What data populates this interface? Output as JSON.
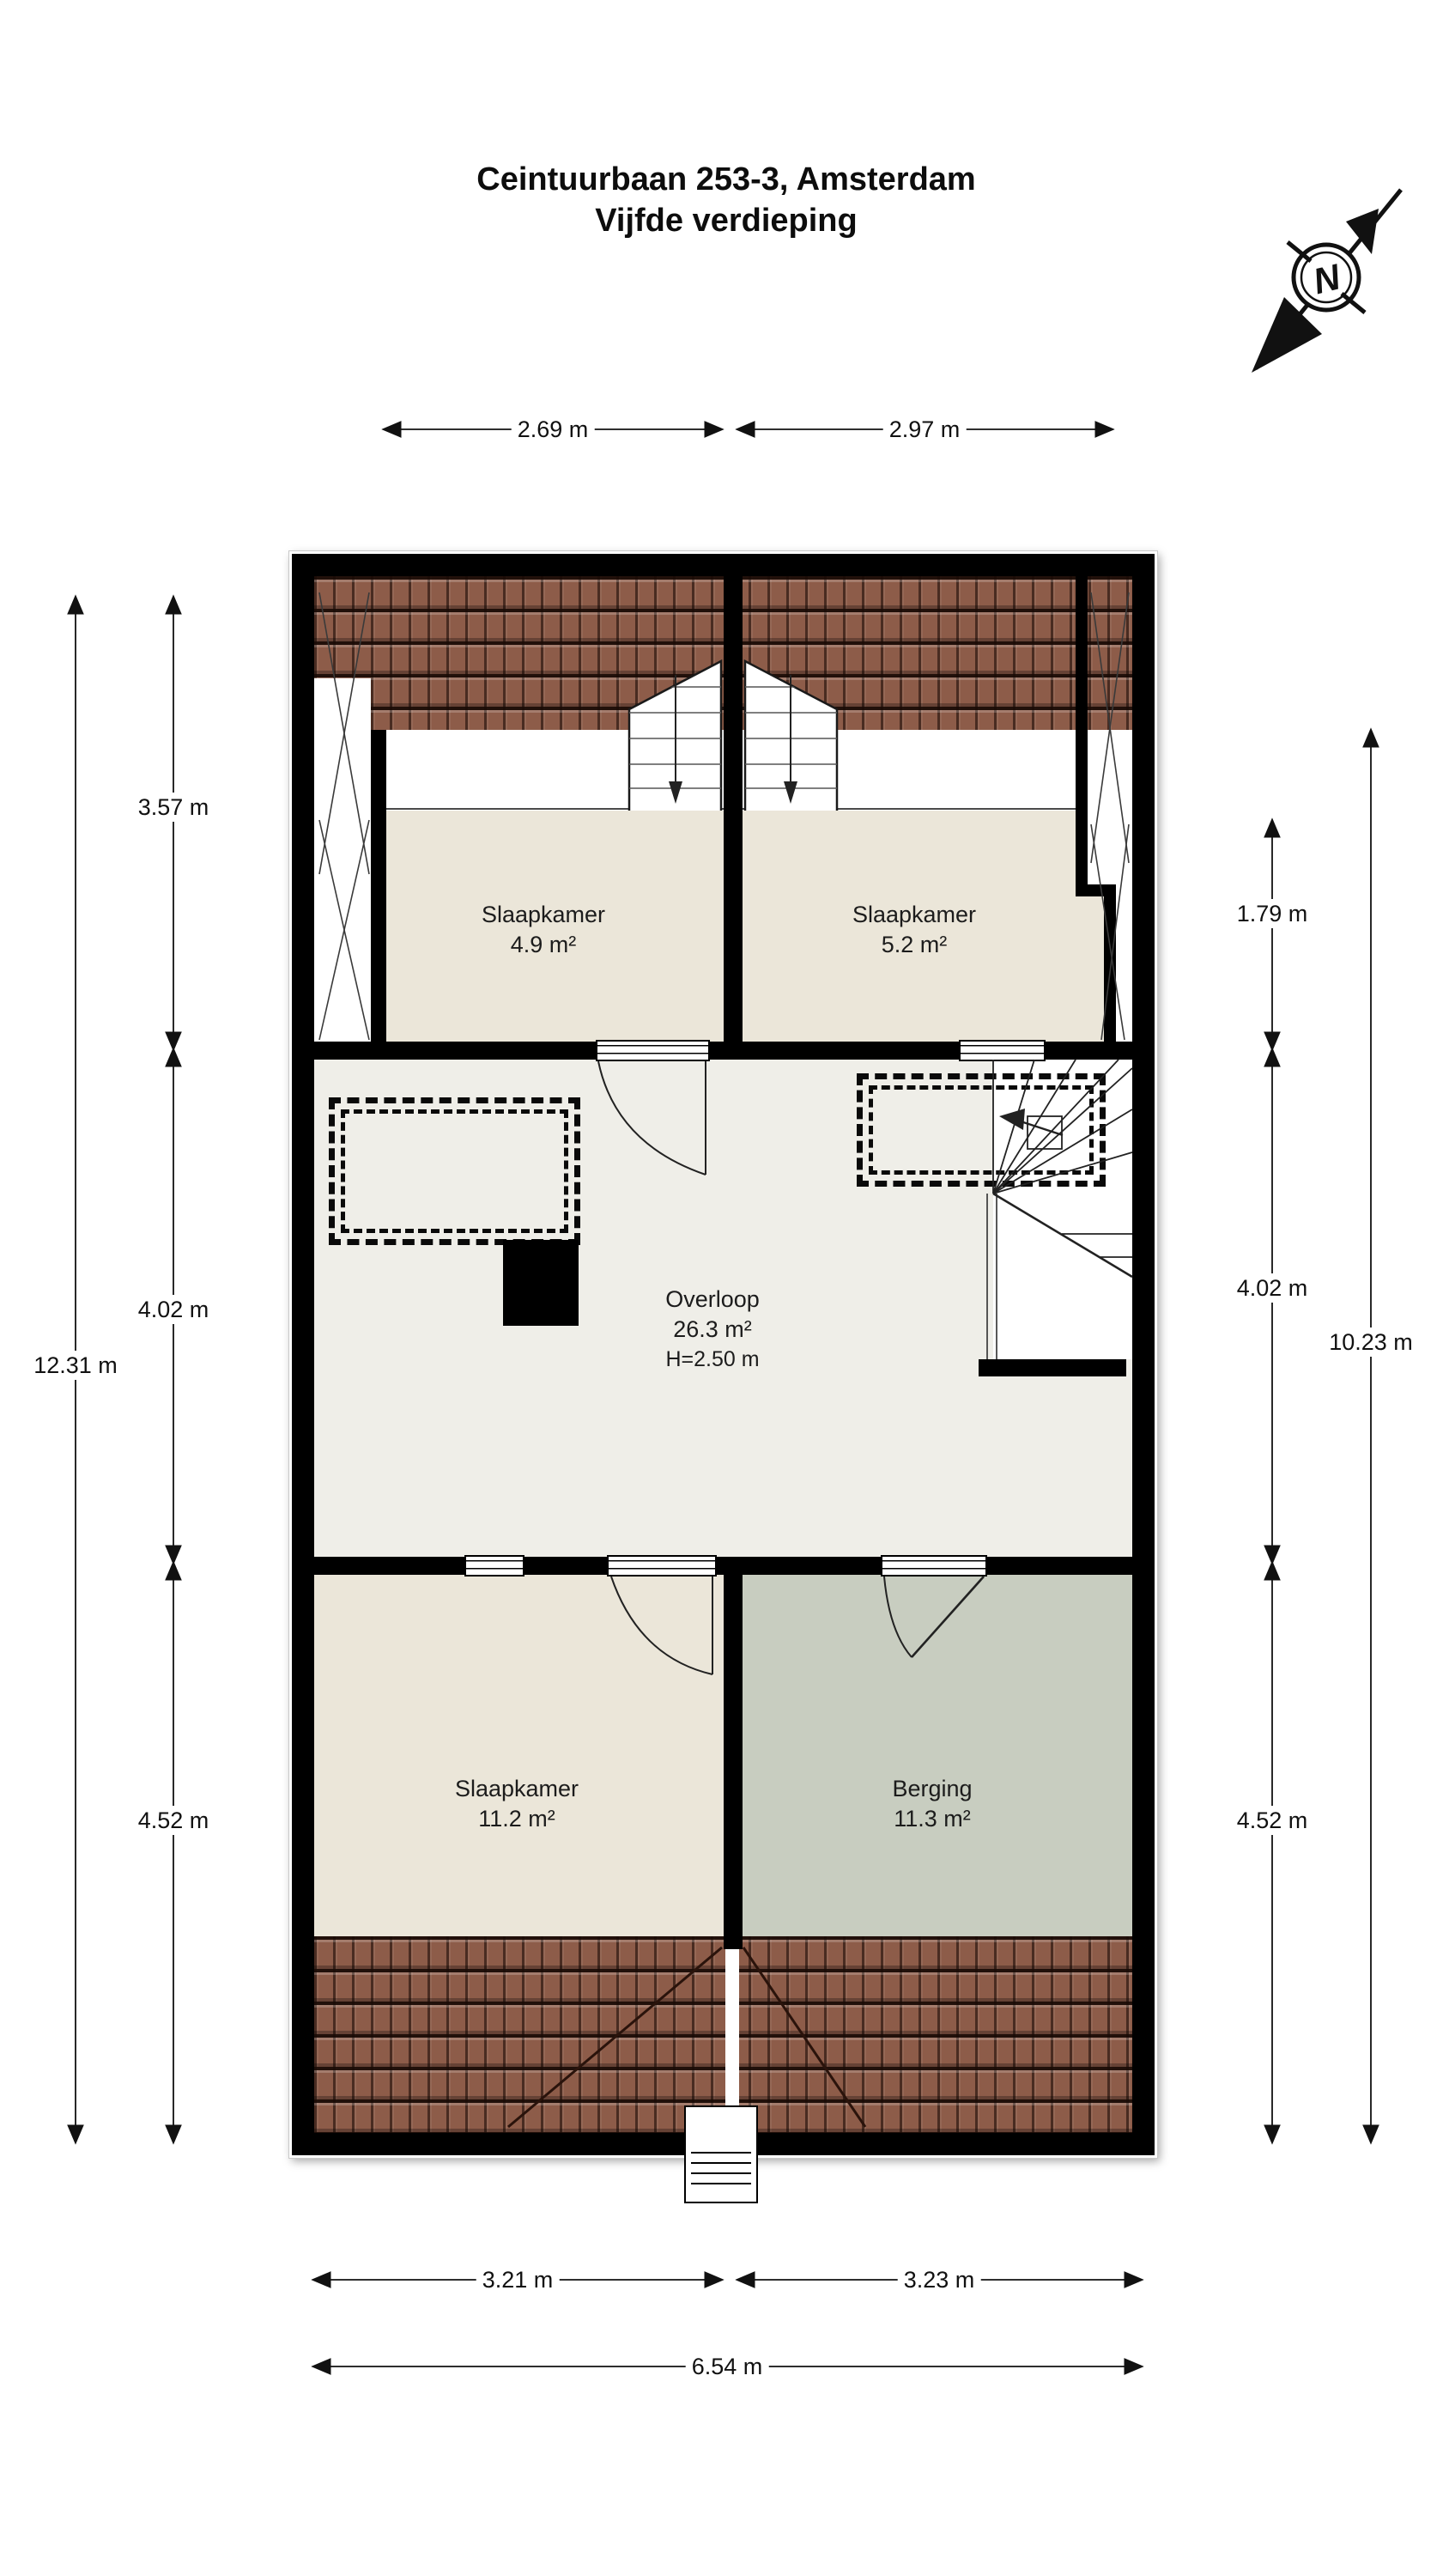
{
  "title": {
    "line1": "Ceintuurbaan 253-3, Amsterdam",
    "line2": "Vijfde verdieping"
  },
  "compass": {
    "letter": "N"
  },
  "rooms": {
    "slaapkamer_tl": {
      "name": "Slaapkamer",
      "area": "4.9 m²"
    },
    "slaapkamer_tr": {
      "name": "Slaapkamer",
      "area": "5.2 m²"
    },
    "overloop": {
      "name": "Overloop",
      "area": "26.3 m²",
      "height": "H=2.50 m"
    },
    "slaapkamer_b": {
      "name": "Slaapkamer",
      "area": "11.2 m²"
    },
    "berging": {
      "name": "Berging",
      "area": "11.3 m²"
    }
  },
  "dimensions": {
    "top": [
      {
        "label": "2.69 m"
      },
      {
        "label": "2.97 m"
      }
    ],
    "left_inner": [
      {
        "label": "3.57 m"
      },
      {
        "label": "4.02 m"
      },
      {
        "label": "4.52 m"
      }
    ],
    "left_total": "12.31 m",
    "right_inner": [
      {
        "label": "1.79 m"
      },
      {
        "label": "4.02 m"
      },
      {
        "label": "4.52 m"
      }
    ],
    "right_total": "10.23 m",
    "bottom": [
      {
        "label": "3.21 m"
      },
      {
        "label": "3.23 m"
      }
    ],
    "bottom_total": "6.54 m"
  },
  "colors": {
    "wall": "#000000",
    "roof_tile": "#8d5c49",
    "roof_line": "#2a130b",
    "floor_beige": "#ebe6d9",
    "floor_light": "#efeee8",
    "floor_gray": "#c8cdc0",
    "line": "#1a1a1a"
  }
}
